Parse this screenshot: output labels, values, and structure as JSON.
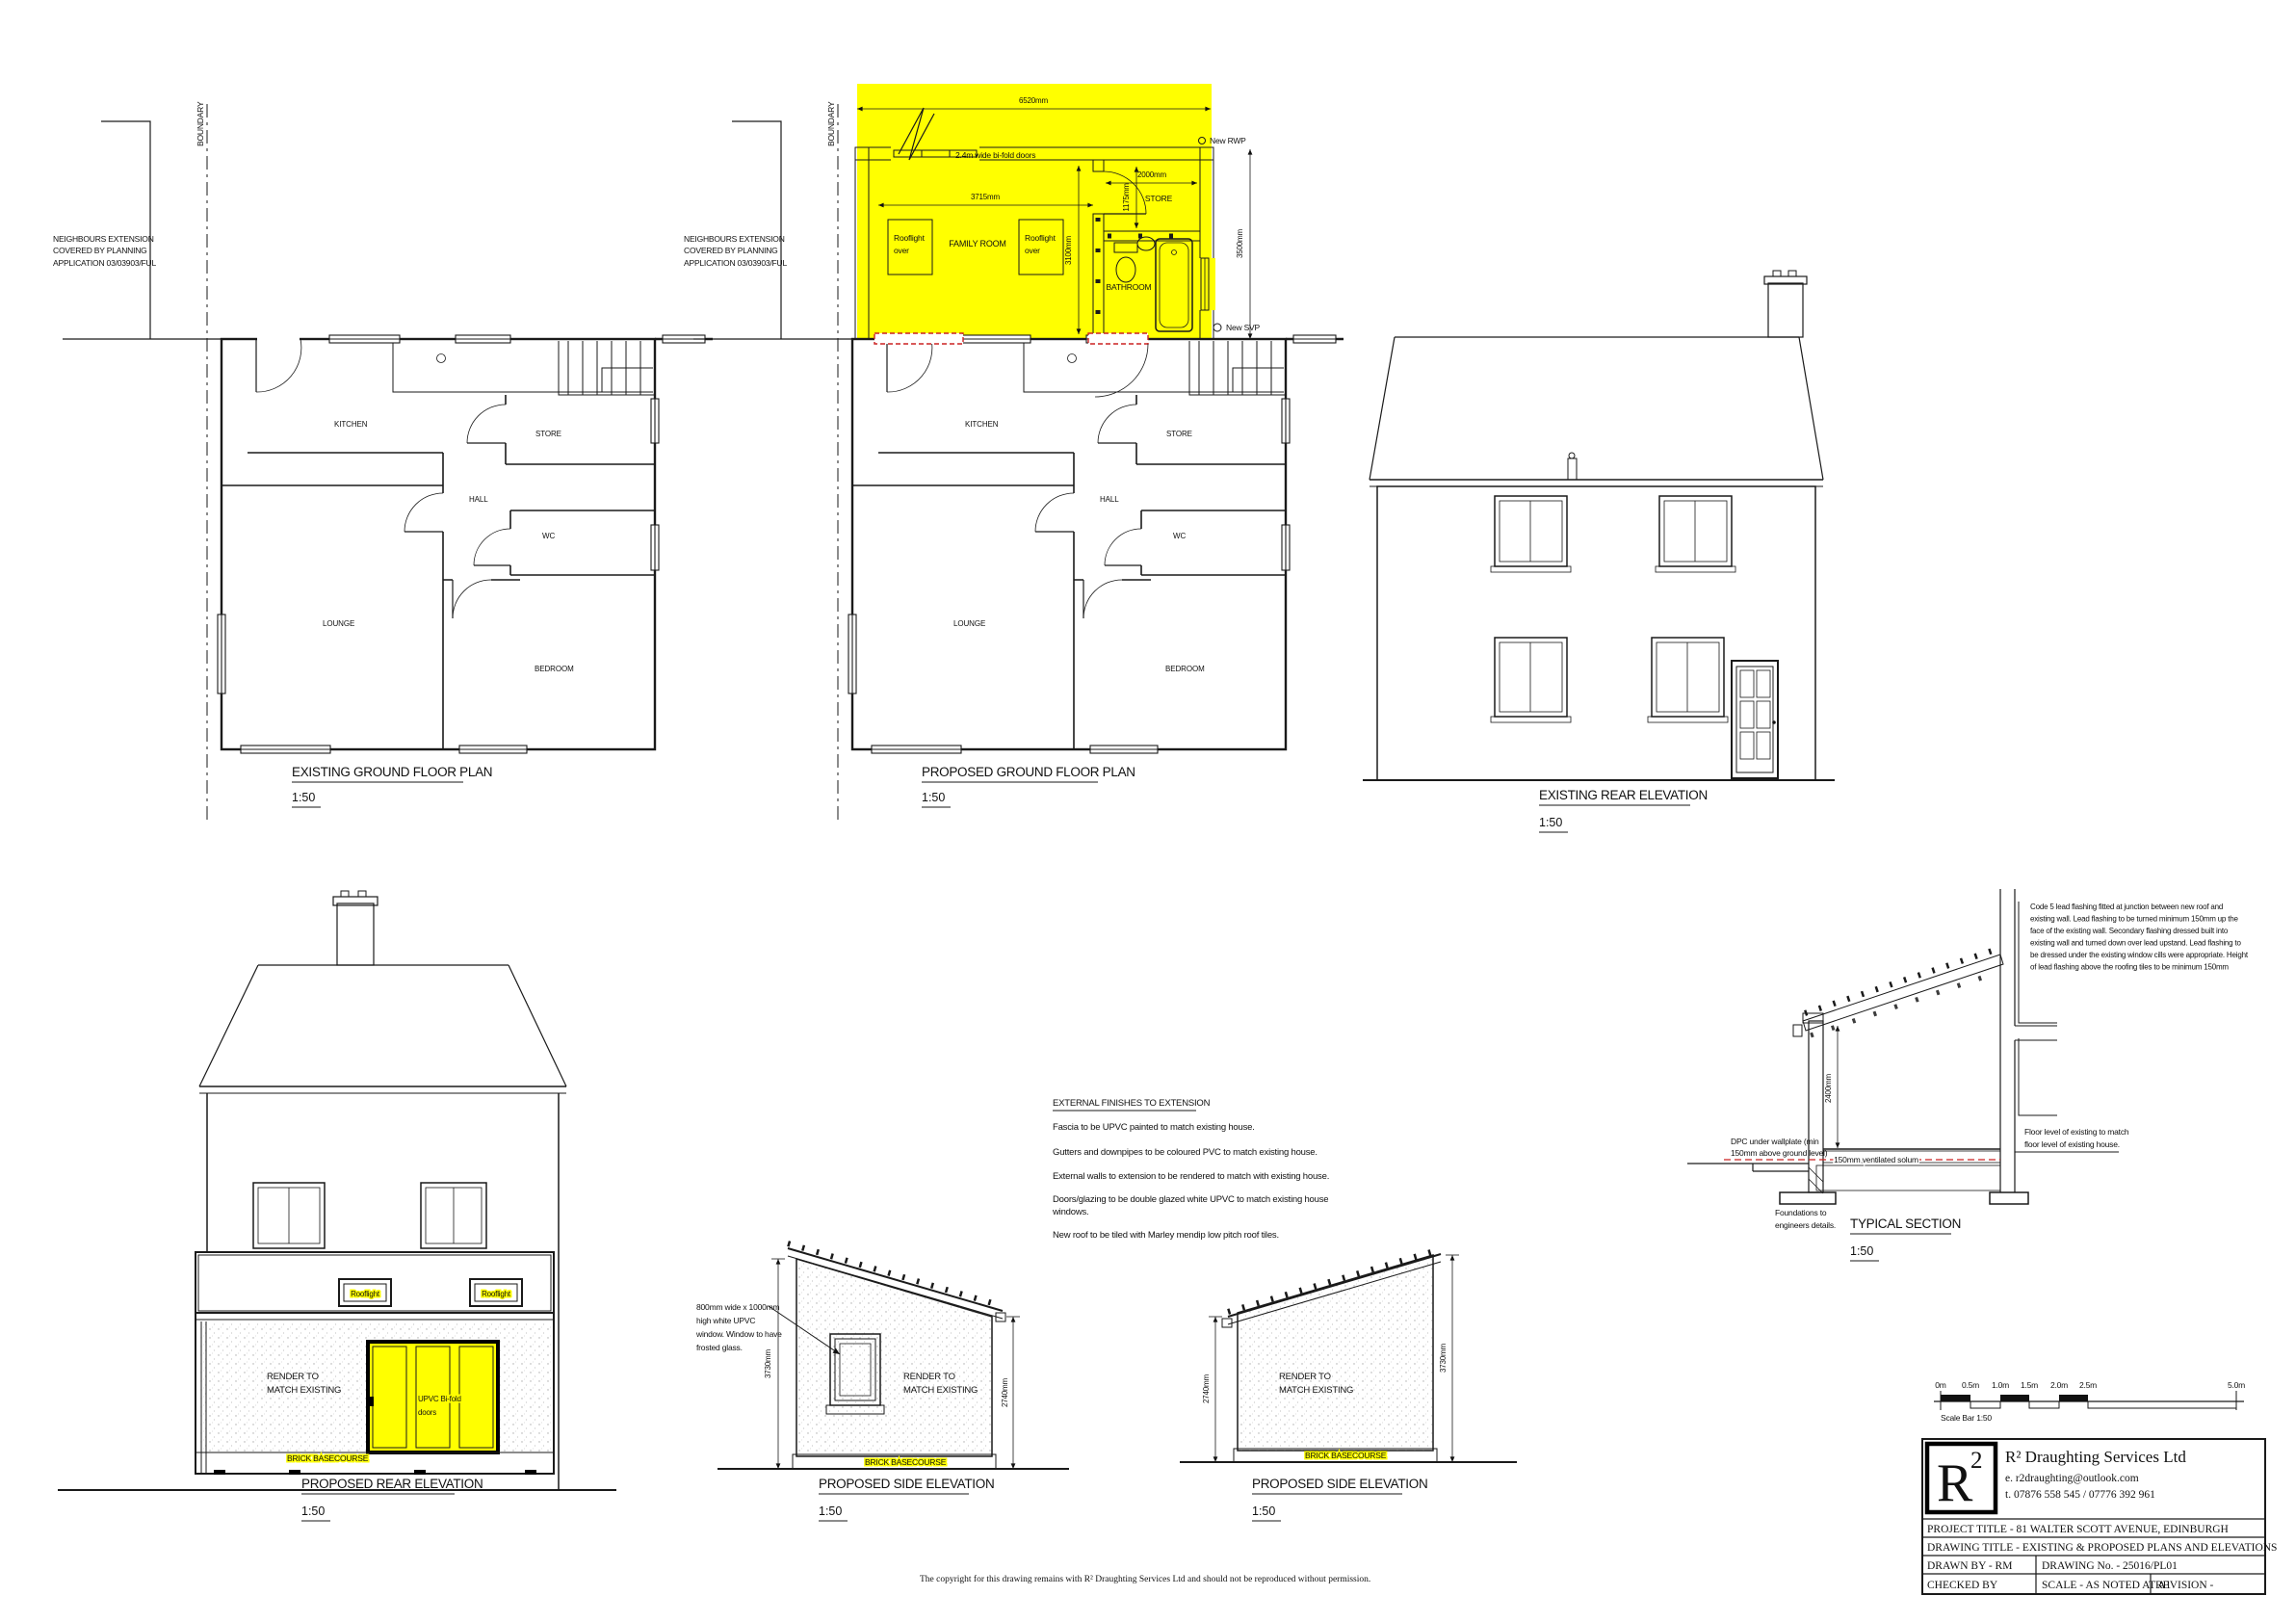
{
  "views": {
    "existing_plan": {
      "title": "EXISTING GROUND FLOOR PLAN",
      "scale": "1:50"
    },
    "proposed_plan": {
      "title": "PROPOSED GROUND FLOOR PLAN",
      "scale": "1:50"
    },
    "existing_rear": {
      "title": "EXISTING REAR ELEVATION",
      "scale": "1:50"
    },
    "proposed_rear": {
      "title": "PROPOSED REAR ELEVATION",
      "scale": "1:50"
    },
    "side_left": {
      "title": "PROPOSED SIDE ELEVATION",
      "scale": "1:50"
    },
    "side_right": {
      "title": "PROPOSED SIDE ELEVATION",
      "scale": "1:50"
    },
    "typical_section": {
      "title": "TYPICAL SECTION",
      "scale": "1:50"
    }
  },
  "site": {
    "boundary_label": "BOUNDARY",
    "neighbour_note": [
      "NEIGHBOURS EXTENSION",
      "COVERED BY PLANNING",
      "APPLICATION 03/03903/FUL"
    ]
  },
  "rooms": {
    "kitchen": "KITCHEN",
    "store": "STORE",
    "hall": "HALL",
    "wc": "WC",
    "lounge": "LOUNGE",
    "bedroom": "BEDROOM"
  },
  "extension_plan": {
    "family_room": "FAMILY ROOM",
    "store": "STORE",
    "bathroom": "BATHROOM",
    "rooflight_line1": "Rooflight",
    "rooflight_line2": "over",
    "bifold_note": "2.4m wide bi-fold doors",
    "new_rwp": "New RWP",
    "new_svp": "New SVP",
    "dim_width": "6520mm",
    "dim_family_width": "3715mm",
    "dim_family_depth": "3100mm",
    "dim_store_width": "2000mm",
    "dim_store_depth": "1175mm",
    "dim_depth": "3500mm"
  },
  "elevations": {
    "render_line1": "RENDER TO",
    "render_line2": "MATCH EXISTING",
    "brick_basecourse": "BRICK BASECOURSE",
    "rooflight": "Rooflight",
    "bifold_line1": "UPVC Bi-fold",
    "bifold_line2": "doors",
    "dim_high": "3730mm",
    "dim_low": "2740mm",
    "window_note": [
      "800mm wide x 1000mm",
      "high white UPVC",
      "window. Window to have",
      "frosted glass."
    ]
  },
  "section": {
    "flashing_note": [
      "Code 5 lead flashing fitted at junction between new roof and",
      "existing wall. Lead flashing to be turned minimum 150mm up the",
      "face of the existing wall. Secondary flashing dressed built into",
      "existing wall and turned down over lead upstand. Lead flashing to",
      "be dressed under the existing window cills were appropriate. Height",
      "of lead flashing above the roofing tiles to be minimum 150mm"
    ],
    "dpc_note": [
      "DPC under wallplate (min",
      "150mm above ground level)"
    ],
    "solum_note": "150mm ventilated solum",
    "floor_level_note": [
      "Floor level of existing to match",
      "floor level of existing house."
    ],
    "foundations_note": [
      "Foundations to",
      "engineers details."
    ],
    "dim_height": "2400mm"
  },
  "finishes_notes": {
    "heading": "EXTERNAL FINISHES TO EXTENSION",
    "lines": [
      "Fascia to be UPVC painted to match existing house.",
      "Gutters and downpipes to be coloured PVC to match existing house.",
      "External walls to extension to be rendered to match with existing house.",
      "Doors/glazing to be double glazed white UPVC to match existing house",
      "windows.",
      "New roof to be tiled with Marley mendip low pitch roof tiles."
    ]
  },
  "scale_bar": {
    "labels": [
      "0m",
      "0.5m",
      "1.0m",
      "1.5m",
      "2.0m",
      "2.5m",
      "5.0m"
    ],
    "caption": "Scale Bar 1:50"
  },
  "title_block": {
    "logo_r": "R",
    "logo_2": "2",
    "company": "R² Draughting Services Ltd",
    "email": "e.  r2draughting@outlook.com",
    "phone": "t.  07876 558 545 / 07776 392 961",
    "project_title": "PROJECT TITLE - 81 WALTER SCOTT AVENUE, EDINBURGH",
    "drawing_title": "DRAWING TITLE - EXISTING & PROPOSED PLANS AND ELEVATIONS",
    "drawn_by": "DRAWN BY - RM",
    "drawing_no": "DRAWING No. - 25016/PL01",
    "checked_by": "CHECKED BY",
    "scale": "SCALE - AS NOTED AT A1",
    "revision": "REVISION -"
  },
  "copyright": "The copyright for this drawing remains with R² Draughting Services Ltd and should not be reproduced without permission.",
  "colors": {
    "highlight": "#ffff00",
    "removed": "#cc2222",
    "line": "#1a1a1a"
  }
}
